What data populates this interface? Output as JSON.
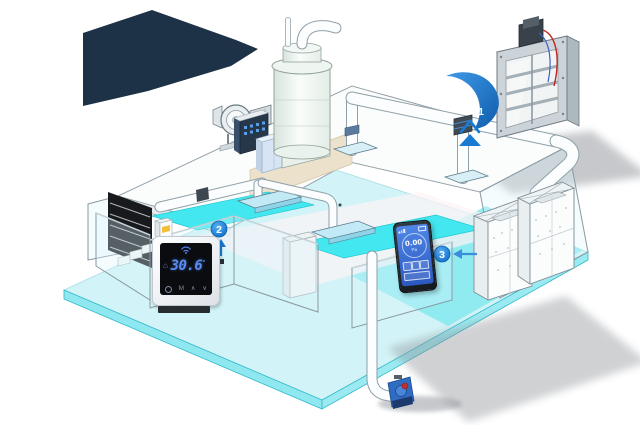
{
  "markers": {
    "m1": "1",
    "m2": "2",
    "m3": "3"
  },
  "thermostat": {
    "value": "30.6",
    "unit_symbol": "°",
    "mode_label": "M"
  },
  "icons": {
    "home": "⌂",
    "caret_up": "∧",
    "caret_down": "∨"
  },
  "meter": {
    "value": "0.00",
    "unit": "Pa"
  },
  "colors": {
    "callout_blue": "#1a7ad2",
    "backdrop_navy": "#1d3147",
    "floor_cyan": "#d2f3f7",
    "pool_cyan": "#42e7ef",
    "thermostat_digits_blue": "#5b8cf4",
    "meter_screen_blue": "#3e73d8",
    "alert_red": "#c03030",
    "highlight_yellow": "#f2bf3a"
  }
}
